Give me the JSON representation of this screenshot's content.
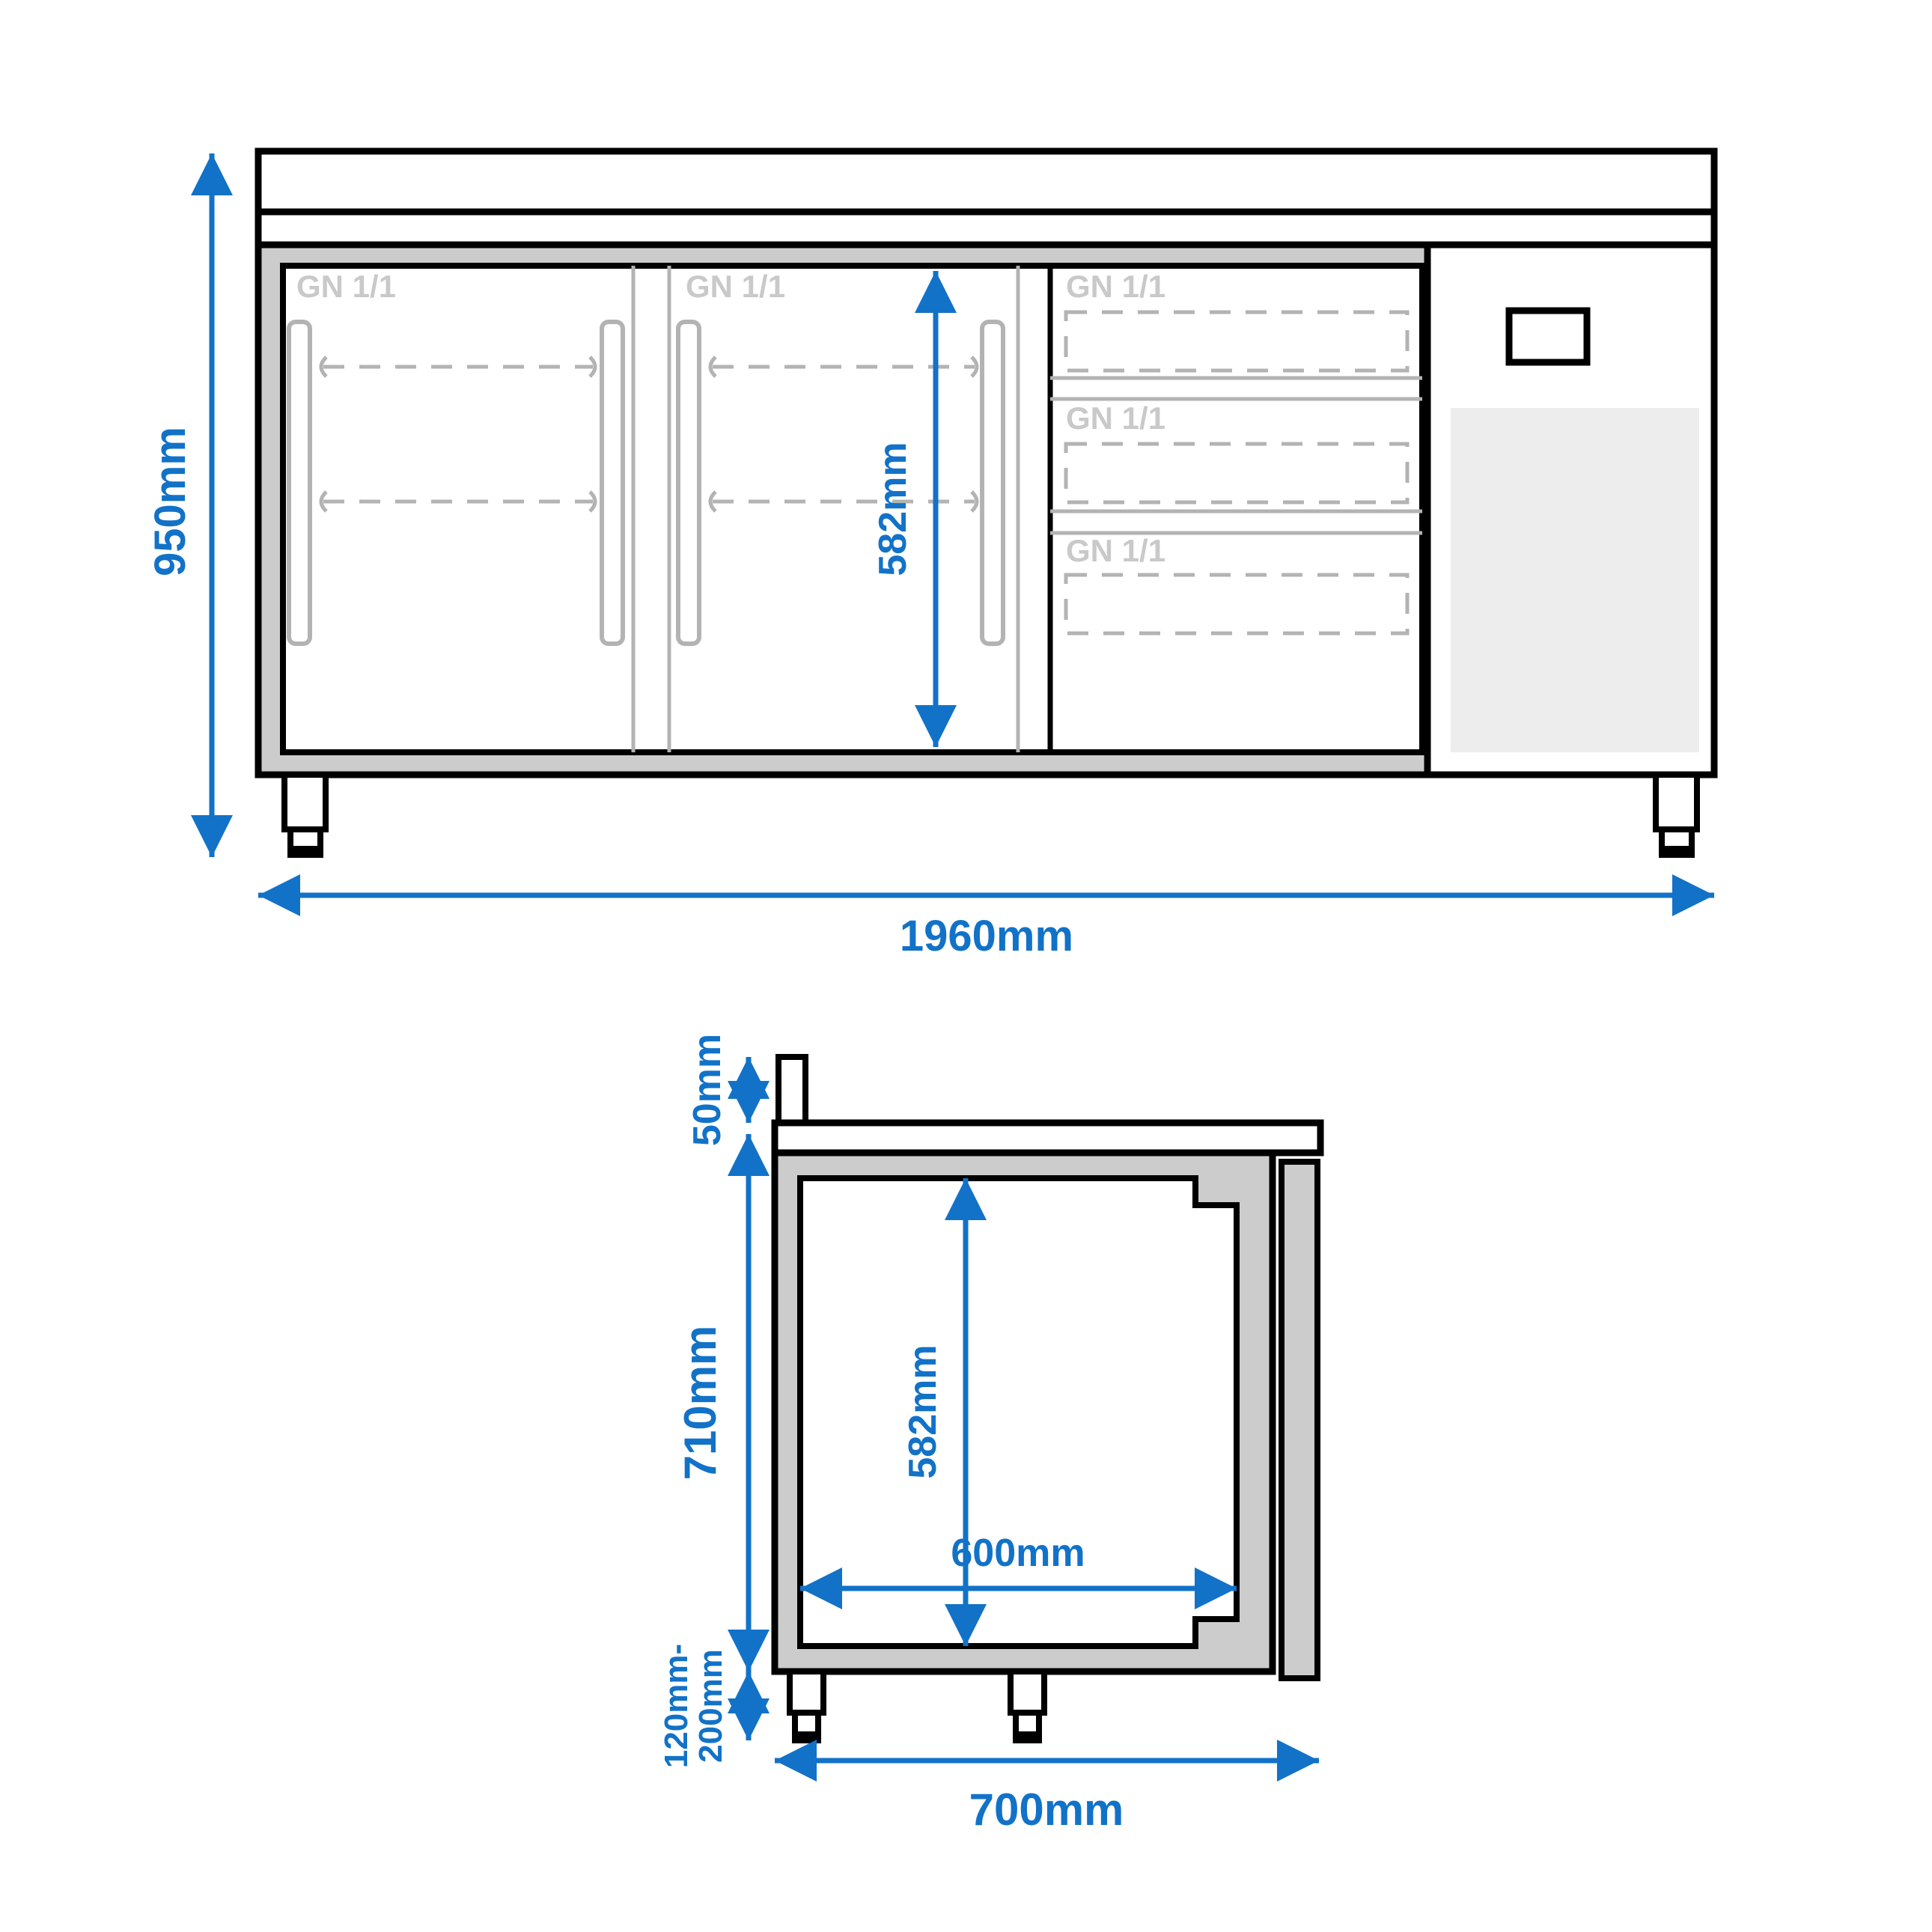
{
  "front_view": {
    "labels": {
      "door1": "GN 1/1",
      "door2": "GN 1/1",
      "drawer1": "GN 1/1",
      "drawer2": "GN 1/1",
      "drawer3": "GN 1/1"
    },
    "dimensions": {
      "height": "950mm",
      "width": "1960mm",
      "interior_height": "582mm"
    }
  },
  "side_view": {
    "dimensions": {
      "upstand_height": "50mm",
      "body_height": "710mm",
      "leg_height_line1": "120mm-",
      "leg_height_line2": "200mm",
      "interior_height": "582mm",
      "interior_depth": "600mm",
      "total_depth": "700mm"
    }
  },
  "colors": {
    "dimension_blue": "#1272c8",
    "panel_gray": "#cccccc",
    "detail_gray": "#b3b3b3",
    "label_gray": "#c9c9c9",
    "vent_gray": "#ededed"
  }
}
